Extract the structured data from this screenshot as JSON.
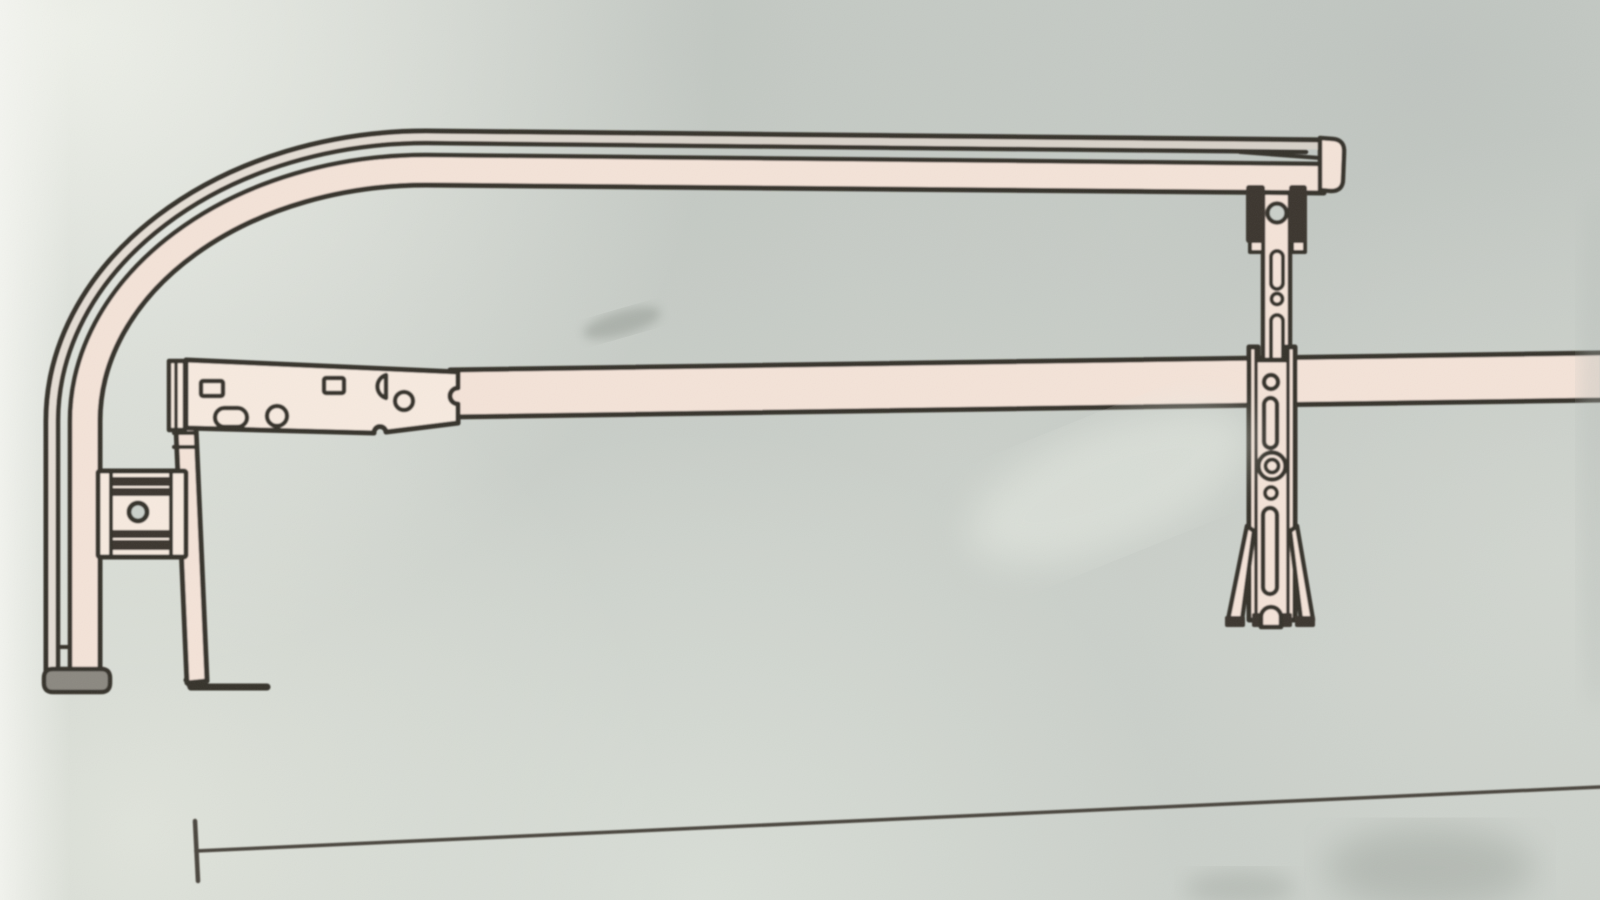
{
  "scene": {
    "kind": "photograph-of-printed-line-diagram",
    "subject": "adjustable truck rack side-rail assembly drawing on paper",
    "visible_text": ""
  },
  "colors": {
    "paper": "#cbd0ca",
    "paper_bright": "#f0f2eb",
    "paper_edge": "#f5f6f1",
    "paper_shade": "#b6bcb7",
    "ink": "#36322b",
    "ink_soft": "#49453d",
    "metal_fill": "#f4e3d8",
    "metal_fill_bright": "#f7eadf",
    "metal_fill_dim": "#ead9cd",
    "hardware_dark": "#3a362d",
    "end_cap_gray": "#8b8880",
    "sheen": "#e8ece4",
    "smudge": "#8f958e"
  },
  "parts": [
    {
      "name": "curved-side-rail-tube"
    },
    {
      "name": "rail-right-end-cap"
    },
    {
      "name": "tube-bottom-end-cap"
    },
    {
      "name": "top-clamp-bracket"
    },
    {
      "name": "upper-adjustable-strut"
    },
    {
      "name": "middle-crossbar"
    },
    {
      "name": "mounting-plate-with-holes"
    },
    {
      "name": "left-drop-bar-with-foot"
    },
    {
      "name": "left-clamp-block"
    },
    {
      "name": "lower-strut-with-splayed-feet"
    },
    {
      "name": "baseline-dimension-line"
    }
  ]
}
